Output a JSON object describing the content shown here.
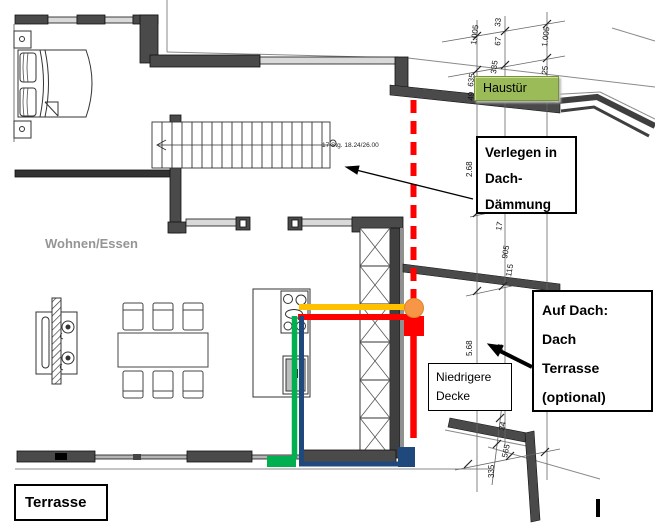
{
  "plan": {
    "room_label": "Wohnen/Essen",
    "stairs_label": "17 Stg. 18.24/26.00"
  },
  "annotations": {
    "haustuer": {
      "label": "Haustür",
      "bg_color": "#9BBB59",
      "border_color": "#76923C"
    },
    "verlegen": {
      "line1": "Verlegen in",
      "line2": "Dach-",
      "line3": "Dämmung"
    },
    "auf_dach": {
      "line1": "Auf Dach:",
      "line2": "Dach",
      "line3": "Terrasse",
      "line4": "(optional)"
    },
    "niedrigere_decke": {
      "line1": "Niedrigere",
      "line2": "Decke"
    },
    "terrasse": {
      "label": "Terrasse"
    }
  },
  "dims": {
    "values": [
      "49",
      "635",
      "1.005",
      "335",
      "67",
      "33",
      "25",
      "1.005",
      "2.68",
      "17",
      "905",
      "115",
      "5.68",
      "24",
      "34",
      "565",
      "335"
    ]
  },
  "colors": {
    "red": "#FF0000",
    "yellow": "#FFC000",
    "orange": "#F79646",
    "orange_border": "#D98728",
    "green": "#00B050",
    "navy": "#1F497D",
    "wall_dark": "#4a4a4a",
    "window_light": "#d9d9d9"
  }
}
